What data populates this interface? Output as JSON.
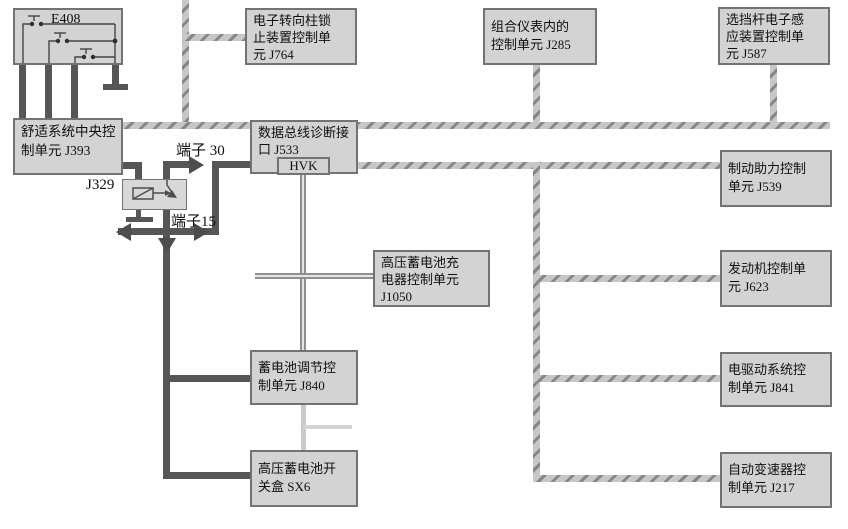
{
  "diagram_title": "",
  "colors": {
    "box_fill": "#d3d3d3",
    "box_border": "#737373",
    "bus_base": "#c7c7c7",
    "bus_hatch": "#868686",
    "power_wire": "#565656",
    "signal_line": "#8f8f8f",
    "light_line": "#c9c9c9",
    "text": "#101010"
  },
  "boxes": {
    "e408": {
      "label": "E408"
    },
    "j393": {
      "l1": "舒适系统中央控",
      "l2": "制单元 J393"
    },
    "j764": {
      "l1": "电子转向柱锁",
      "l2": "止装置控制单",
      "l3": "元 J764"
    },
    "j285": {
      "l1": "组合仪表内的",
      "l2": "控制单元 J285"
    },
    "j587": {
      "l1": "选挡杆电子感",
      "l2": "应装置控制单",
      "l3": "元 J587"
    },
    "j533": {
      "l1": "数据总线诊断接",
      "l2": "口 J533",
      "sub": "HVK"
    },
    "j539": {
      "l1": "制动助力控制",
      "l2": "单元 J539"
    },
    "j1050": {
      "l1": "高压蓄电池充",
      "l2": "电器控制单元",
      "l3": "J1050"
    },
    "j623": {
      "l1": "发动机控制单",
      "l2": "元 J623"
    },
    "j840": {
      "l1": "蓄电池调节控",
      "l2": "制单元 J840"
    },
    "j841": {
      "l1": "电驱动系统控",
      "l2": "制单元 J841"
    },
    "sx6": {
      "l1": "高压蓄电池开",
      "l2": "关盒 SX6"
    },
    "j217": {
      "l1": "自动变速器控",
      "l2": "制单元 J217"
    }
  },
  "labels": {
    "relay": "J329",
    "terminal30": "端子 30",
    "terminal15": "端子15"
  }
}
